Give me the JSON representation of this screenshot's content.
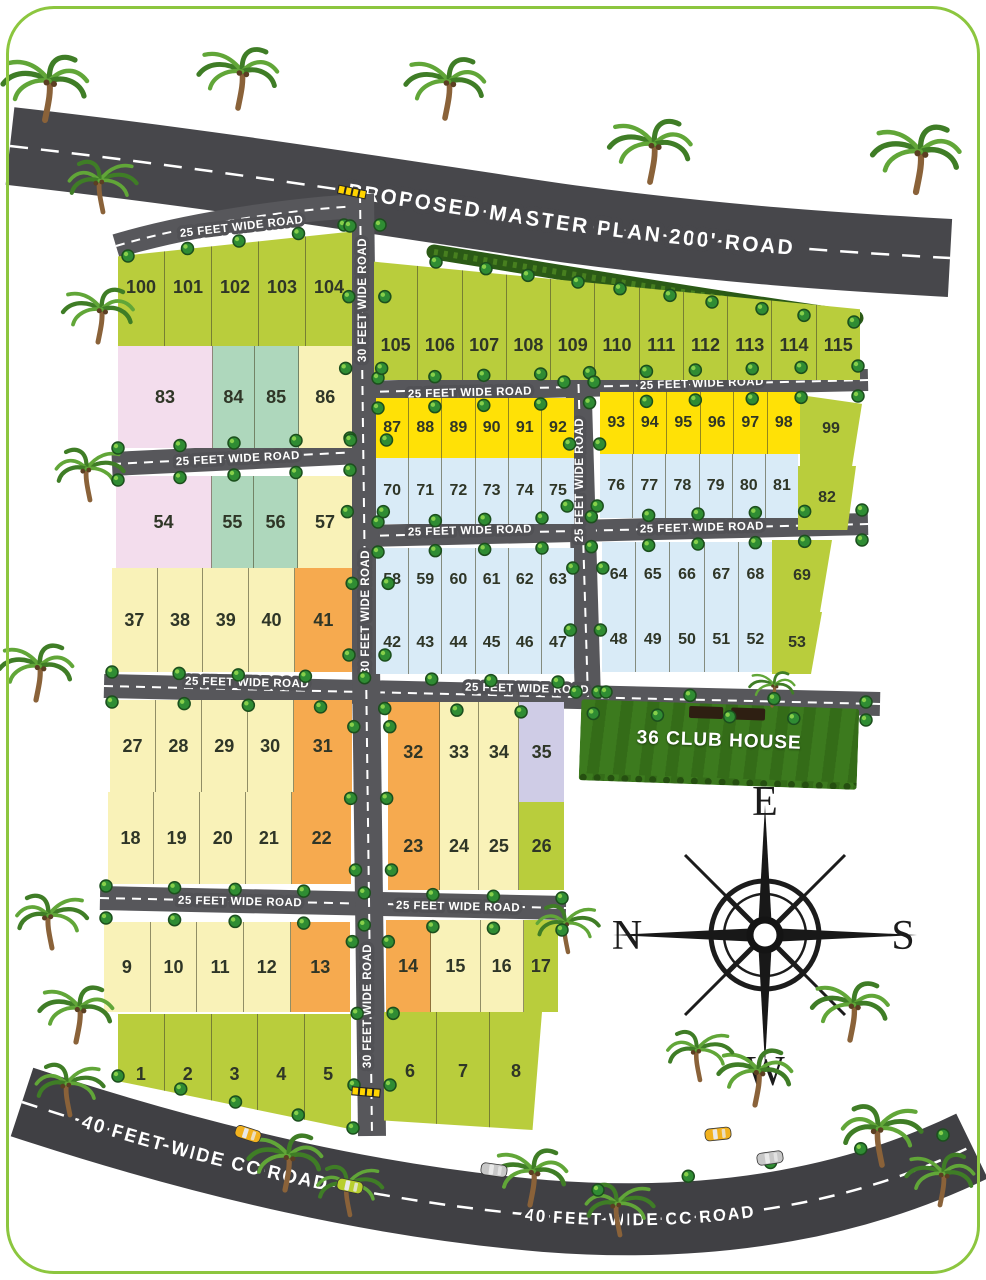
{
  "labels": {
    "top_road": "PROPOSED MASTER PLAN 200' ROAD",
    "road_25": "25 FEET WIDE ROAD",
    "road_30": "30 FEET WIDE ROAD",
    "road_40": "40 FEET WIDE CC ROAD",
    "clubhouse": "36 CLUB HOUSE"
  },
  "compass": {
    "top": "E",
    "left": "N",
    "right": "S",
    "bottom": "W"
  },
  "colors": {
    "green": "#b9cd3c",
    "yellow": "#ffe106",
    "blue": "#d9ebf7",
    "cream": "#f9f2b8",
    "orange": "#f6aa4f",
    "pink": "#f3dded",
    "teal": "#aed7bc",
    "lavender": "#cfcce6",
    "road": "#515155",
    "top_road": "#47474b",
    "bottom_road": "#404044",
    "grass": "#3c7a1e",
    "hedge": "#2b5a16",
    "border": "#8cc63f",
    "car_yellow": "#f2b21f",
    "car_green": "#b8cf2e",
    "car_silver": "#c8c8c8"
  },
  "icons": [
    "palm-tree-icon",
    "bush-icon",
    "car-icon",
    "compass-rose-icon",
    "speed-bump-icon"
  ],
  "blocks": {
    "r100": {
      "cells": [
        {
          "n": "100",
          "c": "green"
        },
        {
          "n": "101",
          "c": "green"
        },
        {
          "n": "102",
          "c": "green"
        },
        {
          "n": "103",
          "c": "green"
        },
        {
          "n": "104",
          "c": "green"
        }
      ]
    },
    "r83": {
      "cells": [
        {
          "n": "83",
          "c": "pink",
          "w": 2.2
        },
        {
          "n": "84",
          "c": "teal",
          "w": 0.95
        },
        {
          "n": "85",
          "c": "teal",
          "w": 1
        },
        {
          "n": "86",
          "c": "cream",
          "w": 1.25
        }
      ]
    },
    "r54": {
      "cells": [
        {
          "n": "54",
          "c": "pink",
          "w": 2.2
        },
        {
          "n": "55",
          "c": "teal",
          "w": 0.95
        },
        {
          "n": "56",
          "c": "teal",
          "w": 1
        },
        {
          "n": "57",
          "c": "cream",
          "w": 1.25
        }
      ]
    },
    "r37": {
      "cells": [
        {
          "n": "37",
          "c": "cream"
        },
        {
          "n": "38",
          "c": "cream"
        },
        {
          "n": "39",
          "c": "cream"
        },
        {
          "n": "40",
          "c": "cream"
        },
        {
          "n": "41",
          "c": "orange",
          "w": 1.28
        }
      ]
    },
    "r27": {
      "cells": [
        {
          "n": "27",
          "c": "cream"
        },
        {
          "n": "28",
          "c": "cream"
        },
        {
          "n": "29",
          "c": "cream"
        },
        {
          "n": "30",
          "c": "cream"
        },
        {
          "n": "31",
          "c": "orange",
          "w": 1.3
        }
      ]
    },
    "r18": {
      "cells": [
        {
          "n": "18",
          "c": "cream"
        },
        {
          "n": "19",
          "c": "cream"
        },
        {
          "n": "20",
          "c": "cream"
        },
        {
          "n": "21",
          "c": "cream"
        },
        {
          "n": "22",
          "c": "orange",
          "w": 1.3
        }
      ]
    },
    "r9": {
      "cells": [
        {
          "n": "9",
          "c": "cream"
        },
        {
          "n": "10",
          "c": "cream"
        },
        {
          "n": "11",
          "c": "cream"
        },
        {
          "n": "12",
          "c": "cream"
        },
        {
          "n": "13",
          "c": "orange",
          "w": 1.3
        }
      ]
    },
    "r1": {
      "cells": [
        {
          "n": "1",
          "c": "green"
        },
        {
          "n": "2",
          "c": "green"
        },
        {
          "n": "3",
          "c": "green"
        },
        {
          "n": "4",
          "c": "green"
        },
        {
          "n": "5",
          "c": "green"
        }
      ]
    },
    "r105": {
      "cells": [
        {
          "n": "105",
          "c": "green"
        },
        {
          "n": "106",
          "c": "green"
        },
        {
          "n": "107",
          "c": "green"
        },
        {
          "n": "108",
          "c": "green"
        },
        {
          "n": "109",
          "c": "green"
        },
        {
          "n": "110",
          "c": "green"
        },
        {
          "n": "111",
          "c": "green"
        },
        {
          "n": "112",
          "c": "green"
        },
        {
          "n": "113",
          "c": "green"
        },
        {
          "n": "114",
          "c": "green"
        },
        {
          "n": "115",
          "c": "green"
        }
      ]
    },
    "r87": {
      "cells": [
        {
          "n": "87",
          "c": "yellow"
        },
        {
          "n": "88",
          "c": "yellow"
        },
        {
          "n": "89",
          "c": "yellow"
        },
        {
          "n": "90",
          "c": "yellow"
        },
        {
          "n": "91",
          "c": "yellow"
        },
        {
          "n": "92",
          "c": "yellow"
        }
      ]
    },
    "r93": {
      "cells": [
        {
          "n": "93",
          "c": "yellow"
        },
        {
          "n": "94",
          "c": "yellow"
        },
        {
          "n": "95",
          "c": "yellow"
        },
        {
          "n": "96",
          "c": "yellow"
        },
        {
          "n": "97",
          "c": "yellow"
        },
        {
          "n": "98",
          "c": "yellow"
        }
      ]
    },
    "r99": {
      "cells": [
        {
          "n": "99",
          "c": "green"
        }
      ]
    },
    "r70": {
      "cells": [
        {
          "n": "70",
          "c": "blue"
        },
        {
          "n": "71",
          "c": "blue"
        },
        {
          "n": "72",
          "c": "blue"
        },
        {
          "n": "73",
          "c": "blue"
        },
        {
          "n": "74",
          "c": "blue"
        },
        {
          "n": "75",
          "c": "blue"
        }
      ]
    },
    "r76": {
      "cells": [
        {
          "n": "76",
          "c": "blue"
        },
        {
          "n": "77",
          "c": "blue"
        },
        {
          "n": "78",
          "c": "blue"
        },
        {
          "n": "79",
          "c": "blue"
        },
        {
          "n": "80",
          "c": "blue"
        },
        {
          "n": "81",
          "c": "blue"
        }
      ]
    },
    "r82": {
      "cells": [
        {
          "n": "82",
          "c": "green"
        }
      ]
    },
    "r58": {
      "cells": [
        {
          "n": "58",
          "c": "blue"
        },
        {
          "n": "59",
          "c": "blue"
        },
        {
          "n": "60",
          "c": "blue"
        },
        {
          "n": "61",
          "c": "blue"
        },
        {
          "n": "62",
          "c": "blue"
        },
        {
          "n": "63",
          "c": "blue"
        }
      ]
    },
    "r64": {
      "cells": [
        {
          "n": "64",
          "c": "blue"
        },
        {
          "n": "65",
          "c": "blue"
        },
        {
          "n": "66",
          "c": "blue"
        },
        {
          "n": "67",
          "c": "blue"
        },
        {
          "n": "68",
          "c": "blue"
        }
      ]
    },
    "r69": {
      "cells": [
        {
          "n": "69",
          "c": "green"
        }
      ]
    },
    "r42": {
      "cells": [
        {
          "n": "42",
          "c": "blue"
        },
        {
          "n": "43",
          "c": "blue"
        },
        {
          "n": "44",
          "c": "blue"
        },
        {
          "n": "45",
          "c": "blue"
        },
        {
          "n": "46",
          "c": "blue"
        },
        {
          "n": "47",
          "c": "blue"
        }
      ]
    },
    "r48": {
      "cells": [
        {
          "n": "48",
          "c": "blue"
        },
        {
          "n": "49",
          "c": "blue"
        },
        {
          "n": "50",
          "c": "blue"
        },
        {
          "n": "51",
          "c": "blue"
        },
        {
          "n": "52",
          "c": "blue"
        }
      ]
    },
    "r53": {
      "cells": [
        {
          "n": "53",
          "c": "green"
        }
      ]
    },
    "r32": {
      "cells": [
        {
          "n": "32",
          "c": "orange",
          "w": 1.3
        },
        {
          "n": "33",
          "c": "cream"
        },
        {
          "n": "34",
          "c": "cream"
        },
        {
          "n": "35",
          "c": "lavender",
          "w": 1.15
        }
      ]
    },
    "r23": {
      "cells": [
        {
          "n": "23",
          "c": "orange",
          "w": 1.3
        },
        {
          "n": "24",
          "c": "cream"
        },
        {
          "n": "25",
          "c": "cream"
        },
        {
          "n": "26",
          "c": "green",
          "w": 1.15
        }
      ]
    },
    "r14": {
      "cells": [
        {
          "n": "14",
          "c": "orange",
          "w": 1.1
        },
        {
          "n": "15",
          "c": "cream",
          "w": 1.2
        },
        {
          "n": "16",
          "c": "cream",
          "w": 1.05
        },
        {
          "n": "17",
          "c": "green",
          "w": 0.85
        }
      ]
    },
    "r6": {
      "cells": [
        {
          "n": "6",
          "c": "green"
        },
        {
          "n": "7",
          "c": "green"
        },
        {
          "n": "8",
          "c": "green"
        }
      ]
    }
  }
}
